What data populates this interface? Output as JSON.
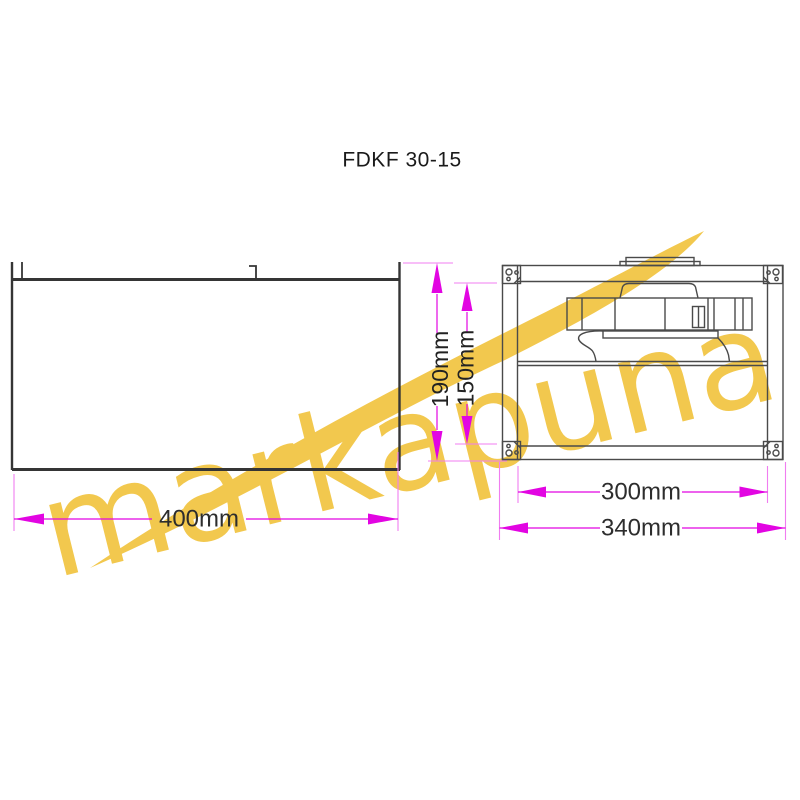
{
  "title": "FDKF 30-15",
  "watermark": {
    "text": "markapuna",
    "color": "#F2C84E"
  },
  "colors": {
    "dimension_accent": "#E205E2",
    "extension_line": "#F07DF0",
    "drawing_line_dark": "#353535",
    "drawing_line_light": "#4a4a4a",
    "label_text": "#2d2d2d",
    "background": "#ffffff"
  },
  "dimensions": {
    "side_length": "400mm",
    "outer_height": "190mm",
    "inner_height": "150mm",
    "inner_width": "300mm",
    "outer_width": "340mm"
  }
}
